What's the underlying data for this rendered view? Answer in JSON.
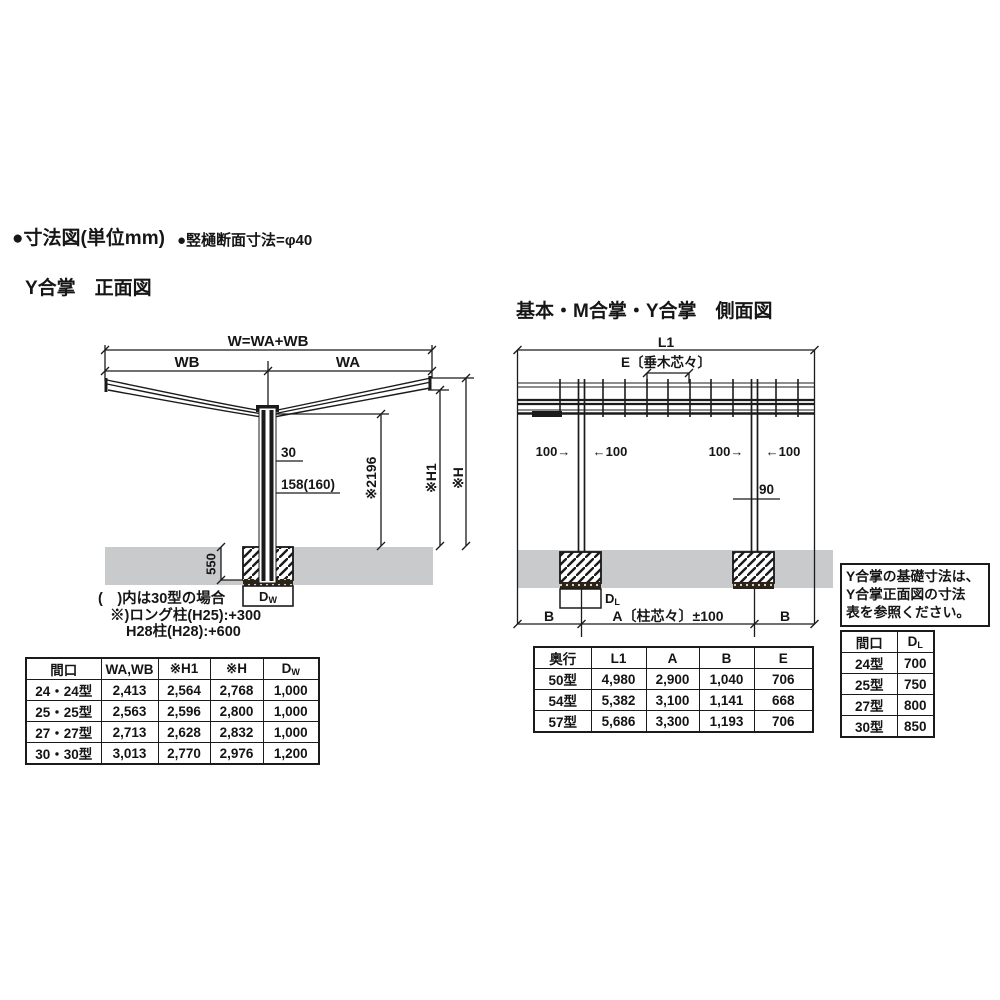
{
  "page": {
    "bullet1": "●寸法図(単位mm)",
    "bullet2": "●竪樋断面寸法=φ40"
  },
  "colors": {
    "line": "#1b1b1b",
    "ground": "#c9cacc"
  },
  "front_view": {
    "title": "Y合掌　正面図",
    "dim_w": "W=WA+WB",
    "dim_wb": "WB",
    "dim_wa": "WA",
    "dim_30": "30",
    "dim_158": "158(160)",
    "dim_2196": "※2196",
    "dim_h1": "※H1",
    "dim_h": "※H",
    "dim_550": "550",
    "dw_base": "D",
    "dw_sub": "W",
    "notes": [
      "(　)内は30型の場合",
      "※)ロング柱(H25):+300",
      "H28柱(H28):+600"
    ]
  },
  "side_view": {
    "title": "基本・M合掌・Y合掌　側面図",
    "dim_l1": "L1",
    "dim_e": "E〔垂木芯々〕",
    "dim_100_in": "100→",
    "dim_100_out": "←100",
    "dim_90": "90",
    "dim_b": "B",
    "dim_a": "A〔柱芯々〕±100",
    "dl_base": "D",
    "dl_sub": "L"
  },
  "note_box": {
    "lines": [
      "Y合掌の基礎寸法は、",
      "Y合掌正面図の寸法",
      "表を参照ください。"
    ]
  },
  "front_table": {
    "headers": [
      "間口",
      "WA,WB",
      "※H1",
      "※H"
    ],
    "header_d_base": "D",
    "header_d_sub": "W",
    "rows": [
      [
        "24・24型",
        "2,413",
        "2,564",
        "2,768",
        "1,000"
      ],
      [
        "25・25型",
        "2,563",
        "2,596",
        "2,800",
        "1,000"
      ],
      [
        "27・27型",
        "2,713",
        "2,628",
        "2,832",
        "1,000"
      ],
      [
        "30・30型",
        "3,013",
        "2,770",
        "2,976",
        "1,200"
      ]
    ]
  },
  "depth_table": {
    "headers": [
      "奥行",
      "L1",
      "A",
      "B",
      "E"
    ],
    "rows": [
      [
        "50型",
        "4,980",
        "2,900",
        "1,040",
        "706"
      ],
      [
        "54型",
        "5,382",
        "3,100",
        "1,141",
        "668"
      ],
      [
        "57型",
        "5,686",
        "3,300",
        "1,193",
        "706"
      ]
    ]
  },
  "dl_table": {
    "header_col1": "間口",
    "header_d_base": "D",
    "header_d_sub": "L",
    "rows": [
      [
        "24型",
        "700"
      ],
      [
        "25型",
        "750"
      ],
      [
        "27型",
        "800"
      ],
      [
        "30型",
        "850"
      ]
    ]
  }
}
